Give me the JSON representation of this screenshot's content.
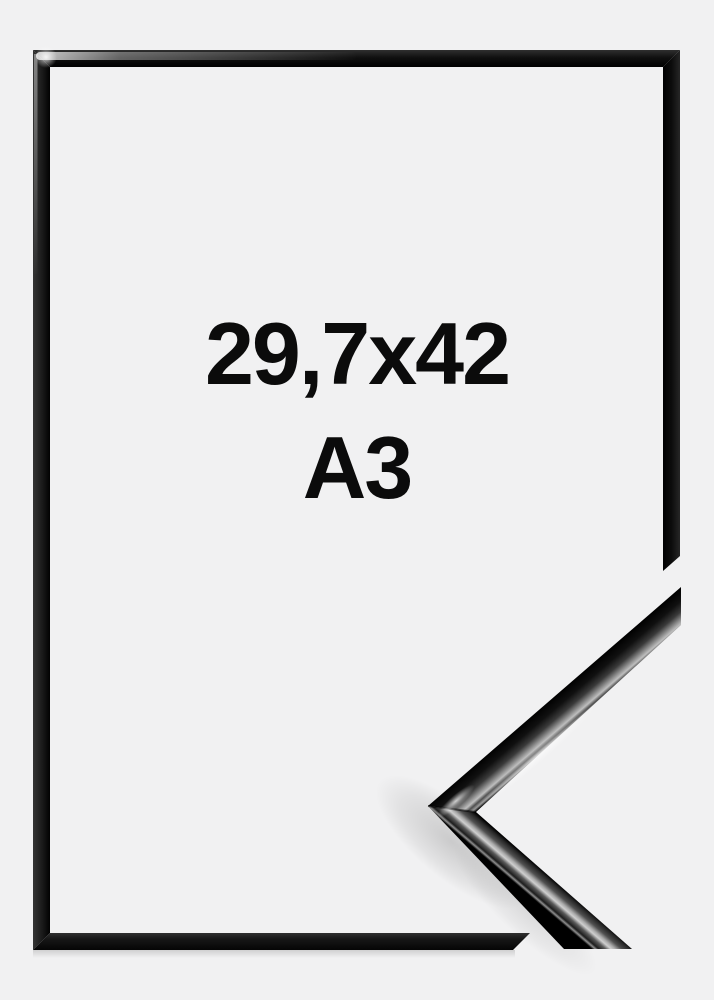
{
  "image": {
    "background_color": "#f1f1f2",
    "frame_color": "#0b0b0b",
    "text_color": "#0b0b0b"
  },
  "product": {
    "size_label": "29,7x42",
    "format_label": "A3"
  }
}
